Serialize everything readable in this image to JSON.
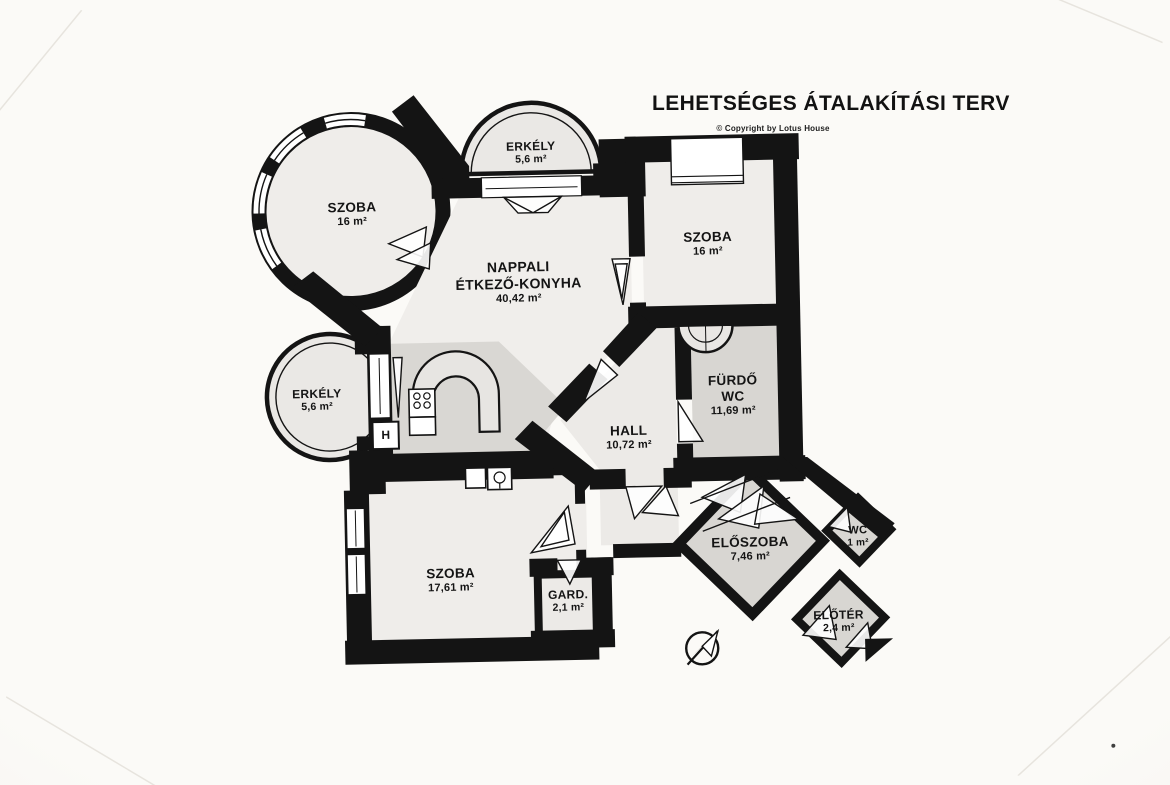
{
  "header": {
    "title": "LEHETSÉGES ÁTALAKÍTÁSI TERV",
    "copyright": "© Copyright by Lotus House"
  },
  "rooms": [
    {
      "id": "erkely-top",
      "line1": "ERKÉLY",
      "line2": "",
      "area": "5,6 m²"
    },
    {
      "id": "szoba-tower",
      "line1": "SZOBA",
      "line2": "",
      "area": "16 m²"
    },
    {
      "id": "nappali",
      "line1": "NAPPALI",
      "line2": "ÉTKEZŐ-KONYHA",
      "area": "40,42 m²"
    },
    {
      "id": "szoba-right",
      "line1": "SZOBA",
      "line2": "",
      "area": "16 m²"
    },
    {
      "id": "furdo",
      "line1": "FÜRDŐ",
      "line2": "WC",
      "area": "11,69 m²"
    },
    {
      "id": "erkely-left",
      "line1": "ERKÉLY",
      "line2": "",
      "area": "5,6 m²"
    },
    {
      "id": "hall",
      "line1": "HALL",
      "line2": "",
      "area": "10,72 m²"
    },
    {
      "id": "szoba-bottom",
      "line1": "SZOBA",
      "line2": "",
      "area": "17,61 m²"
    },
    {
      "id": "gard",
      "line1": "GARD.",
      "line2": "",
      "area": "2,1 m²"
    },
    {
      "id": "eloszoba",
      "line1": "ELŐSZOBA",
      "line2": "",
      "area": "7,46 m²"
    },
    {
      "id": "wc",
      "line1": "WC",
      "line2": "",
      "area": "1 m²"
    },
    {
      "id": "eloter",
      "line1": "ELŐTÉR",
      "line2": "",
      "area": "2,4 m²"
    }
  ],
  "annotations": {
    "fridge_label": "H"
  },
  "icons": {
    "compass": "north-arrow-icon",
    "entrance": "entrance-direction-marker"
  },
  "colors": {
    "wall": "#141414",
    "paper": "#f8f6f3",
    "room": "#efedea",
    "shaded": "#d8d6d2"
  }
}
